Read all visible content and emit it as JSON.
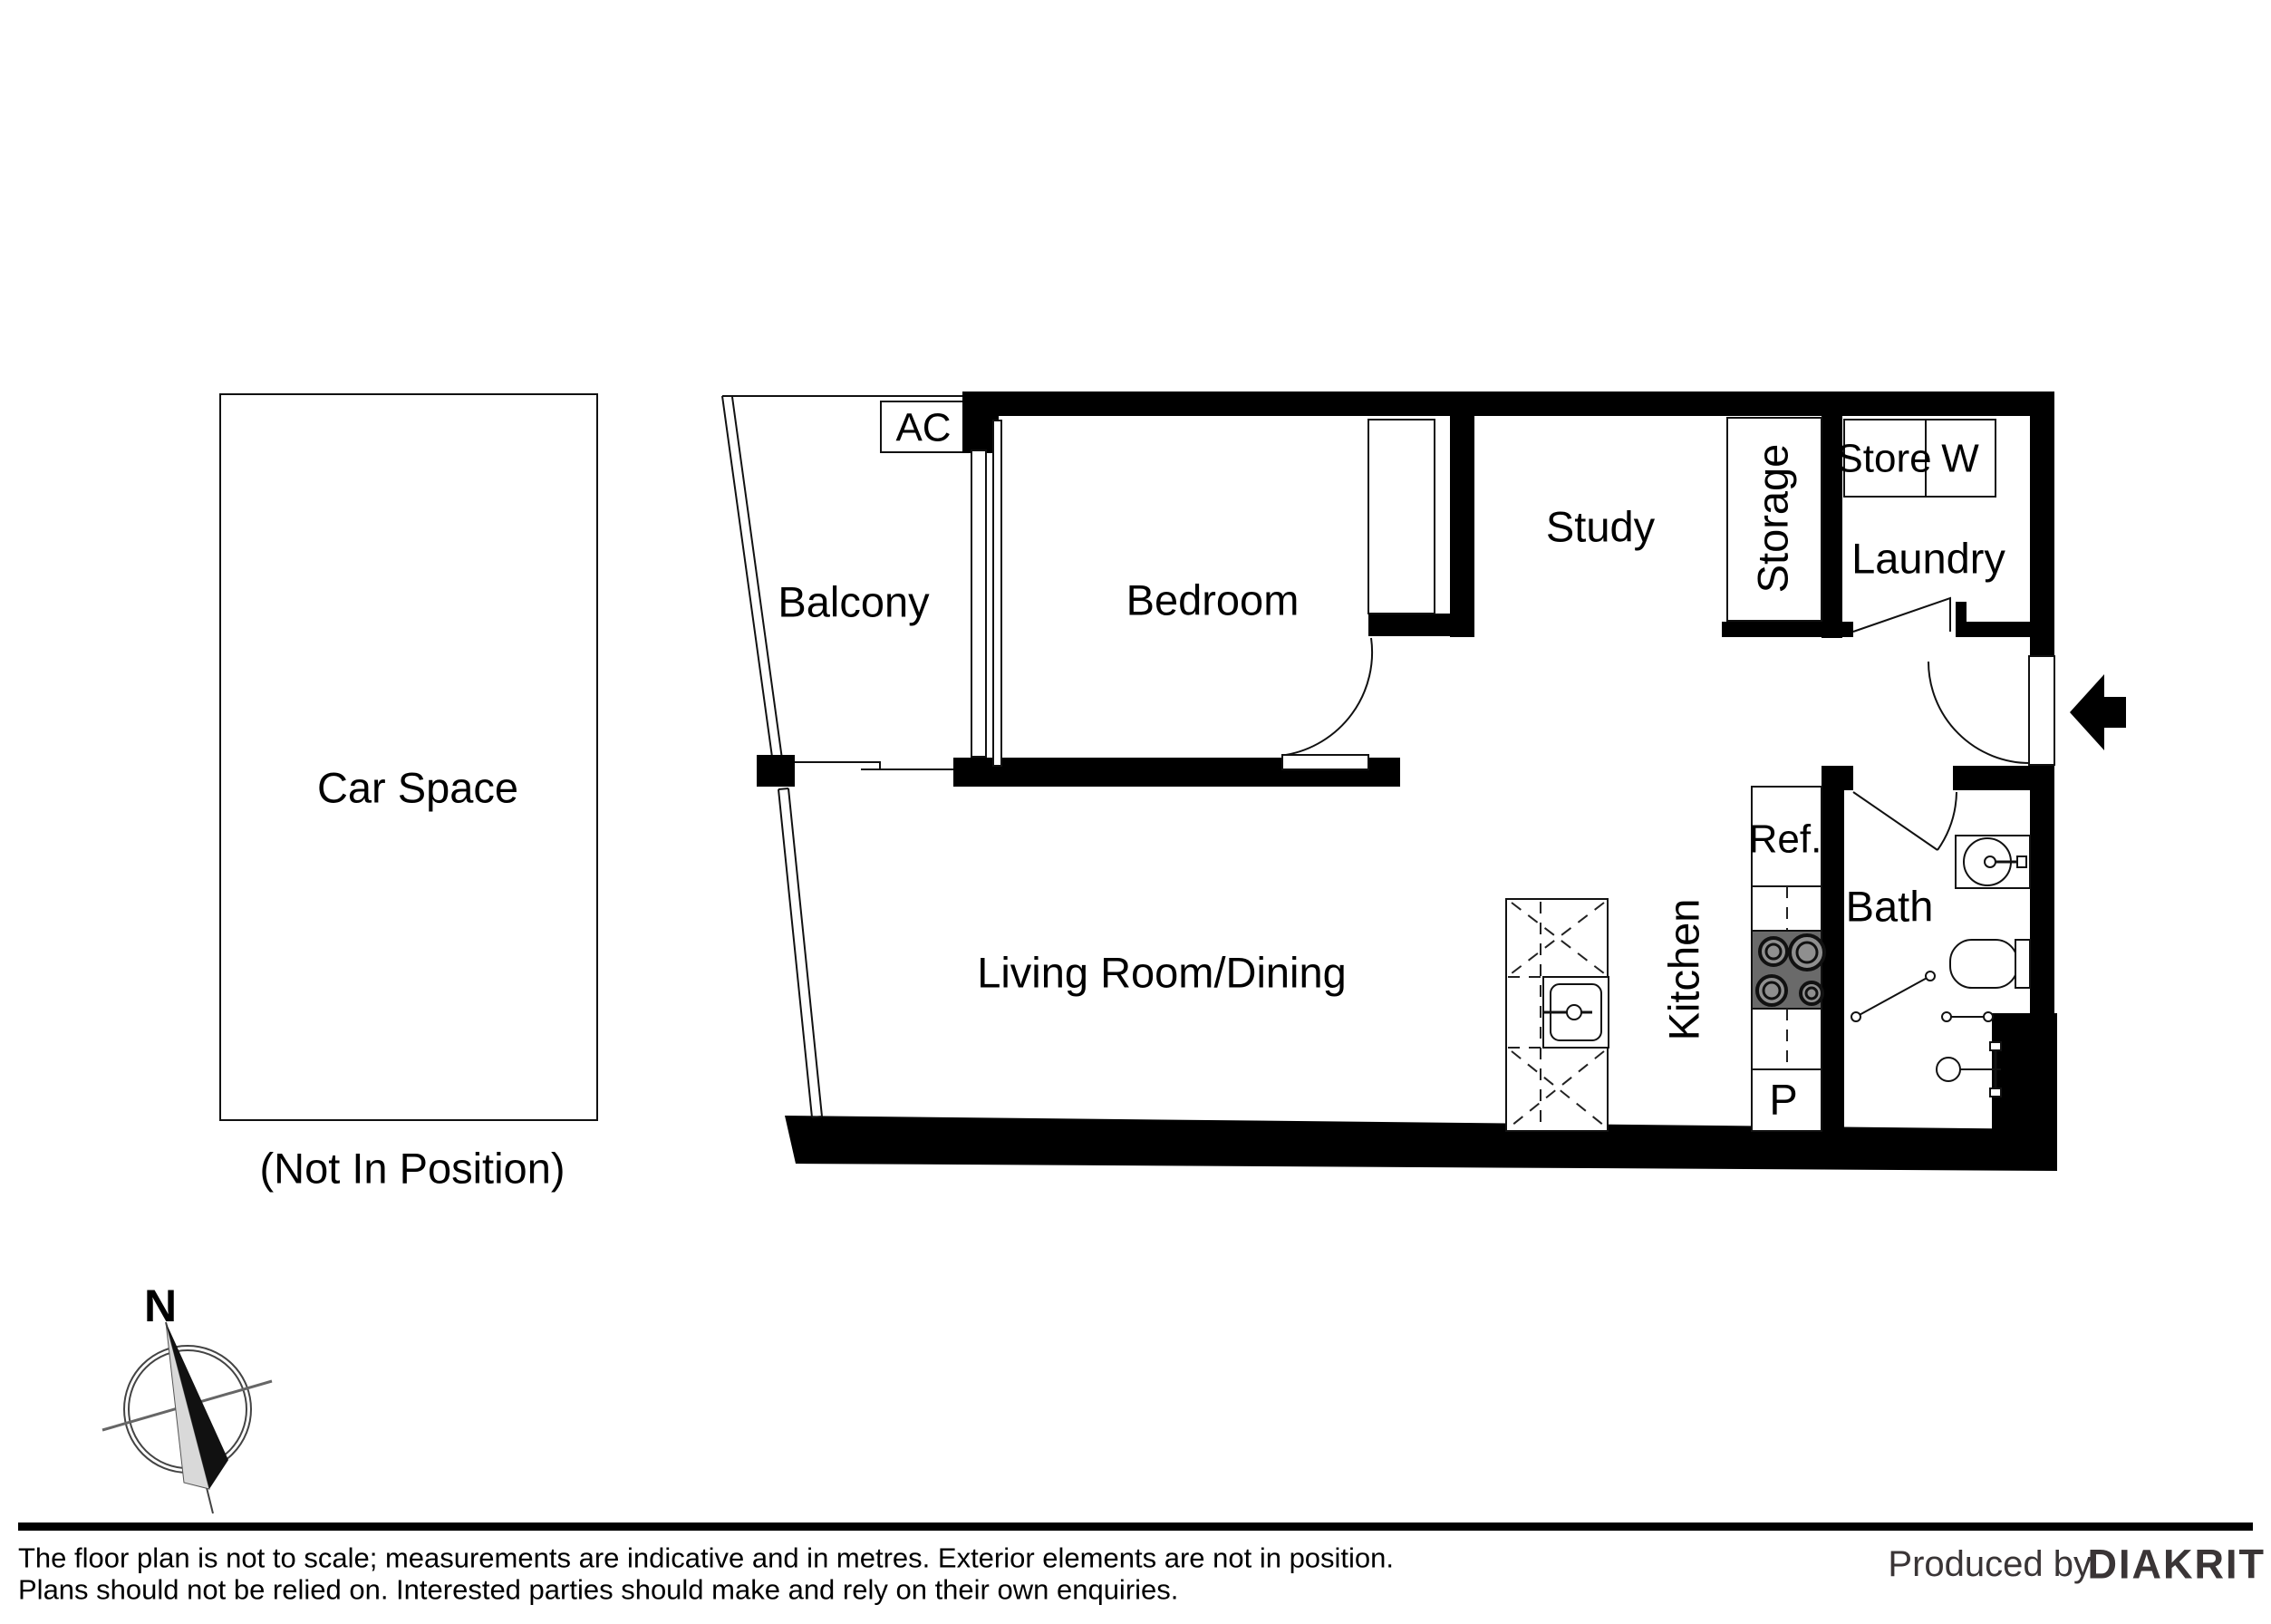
{
  "plan": {
    "rooms": {
      "balcony": "Balcony",
      "bedroom": "Bedroom",
      "study": "Study",
      "storage": "Storage",
      "store": "Store",
      "washer": "W",
      "laundry": "Laundry",
      "living_dining": "Living Room/Dining",
      "kitchen": "Kitchen",
      "fridge": "Ref.",
      "pantry": "P",
      "bath": "Bath"
    },
    "annotations": {
      "ac": "AC"
    },
    "car_space": {
      "label": "Car Space",
      "note": "(Not In Position)"
    },
    "compass": {
      "north": "N"
    }
  },
  "footer": {
    "disclaimer_line1": "The floor plan is not to scale; measurements are indicative and in metres. Exterior elements are not in position.",
    "disclaimer_line2": "Plans should not be relied on. Interested parties should make and rely on their own enquiries.",
    "produced_by": "Produced by",
    "brand": "DIAKRIT"
  },
  "colors": {
    "wall": "#000000",
    "line": "#111111",
    "cooktop": "#6a6a6a",
    "burner": "#8f8f8f",
    "needle_dark": "#111111",
    "needle_light": "#d9d9d9",
    "brand_text": "#3a3536",
    "background": "#ffffff"
  }
}
